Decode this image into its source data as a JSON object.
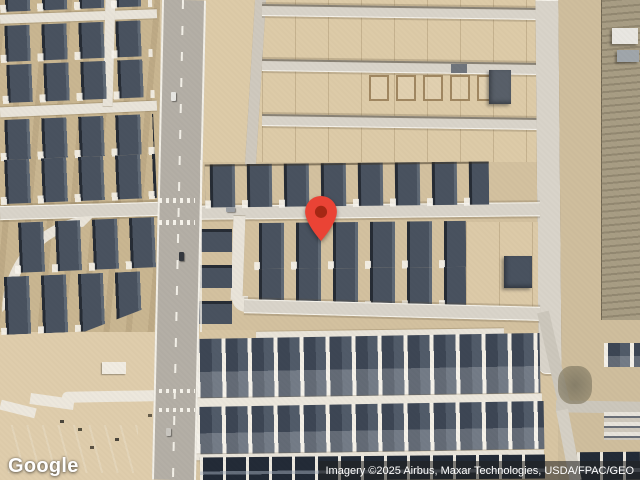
{
  "page": {
    "type": "satellite-map-view",
    "description": "Aerial satellite imagery of a desert suburban subdivision with a red location marker"
  },
  "branding": {
    "logo_text": "Google"
  },
  "attribution": {
    "text": "Imagery ©2025 Airbus, Maxar Technologies, USDA/FPAC/GEO"
  },
  "marker": {
    "kind": "location-pin",
    "color": "#EA4335",
    "inner_color": "#A52714"
  },
  "theme": {
    "street-white": "#e9e4d9",
    "road-concrete": "#d9d4ca",
    "asphalt": "#b4afa6",
    "white-line": "#f3f0e8",
    "sand": "#d7c5a3",
    "sand-light": "#ddcba8",
    "sand-brown": "#c9b691",
    "desert": "#a89d84",
    "roof": "#49525f",
    "roof-shadow": "#262c35",
    "roof-light": "#5f6975",
    "roof-dense": "#3d4654",
    "roof-darkest": "#232b37",
    "marker-red": "#EA4335",
    "marker-inner": "#A52714",
    "attr-bg": "rgba(33,33,33,0.55)"
  }
}
